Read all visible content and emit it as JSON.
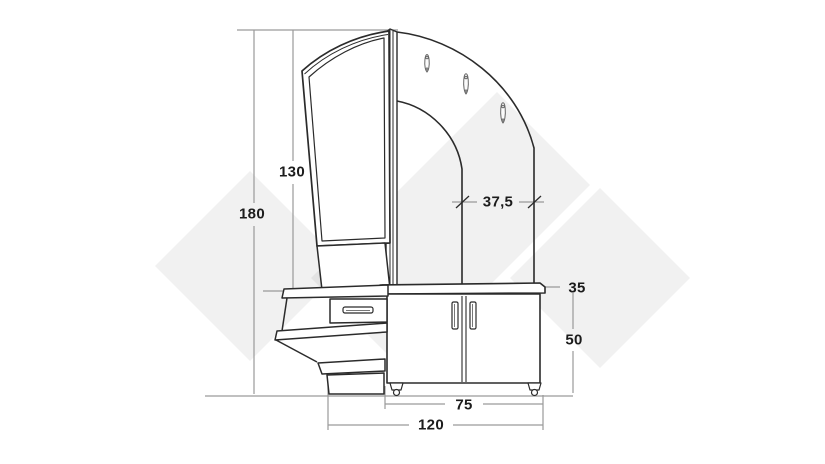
{
  "diagram": {
    "kind": "furniture dimension drawing",
    "subject": "Hallway stand with tilted mirror, arched coat-hook panel, drawer console and two-door cabinet on feet",
    "hook_count": 3,
    "door_count": 2,
    "drawer_count": 1,
    "dimensions": [
      {
        "id": "total-height",
        "value": "180"
      },
      {
        "id": "mirror-height",
        "value": "130"
      },
      {
        "id": "hook-panel-width",
        "value": "37,5"
      },
      {
        "id": "cabinet-depth",
        "value": "35"
      },
      {
        "id": "cabinet-height",
        "value": "50"
      },
      {
        "id": "cabinet-width",
        "value": "75"
      },
      {
        "id": "total-width",
        "value": "120"
      }
    ],
    "colors": {
      "background": "#ffffff",
      "watermark_diamond": "#ececec",
      "furniture_outline": "#2b2b2b",
      "dimension_lines": "#9a9a9a",
      "dimension_text": "#1c1c1c"
    }
  }
}
